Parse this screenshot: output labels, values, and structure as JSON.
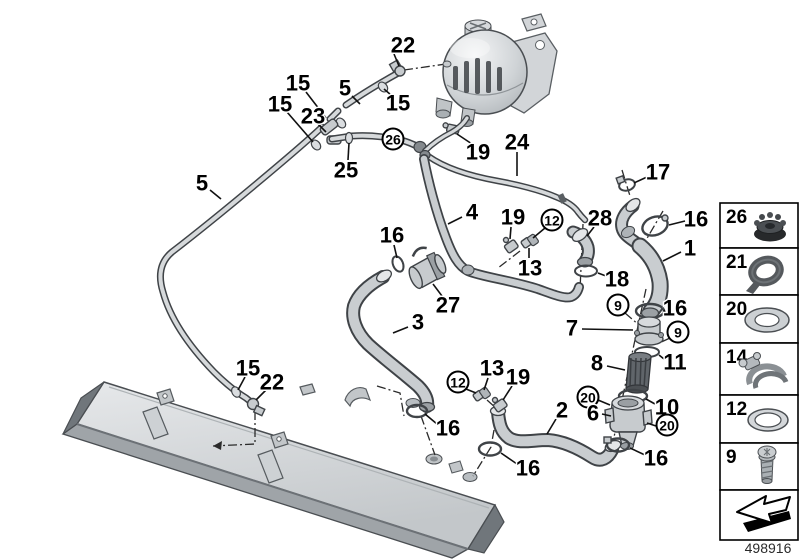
{
  "part_number": "498916",
  "sidebar": {
    "items": [
      {
        "number": "26",
        "icon": "rubber-mount-icon"
      },
      {
        "number": "21",
        "icon": "strap-loop-icon"
      },
      {
        "number": "20",
        "icon": "washer-icon"
      },
      {
        "number": "14",
        "icon": "hose-clamp-icon"
      },
      {
        "number": "12",
        "icon": "seal-ring-icon"
      },
      {
        "number": "9",
        "icon": "screw-icon"
      }
    ],
    "arrow_icon": "direction-arrow-icon"
  },
  "callouts": [
    {
      "text": "22",
      "x": 403,
      "y": 45,
      "circled": false,
      "leader": "394,54 399,66"
    },
    {
      "text": "15",
      "x": 398,
      "y": 103,
      "circled": false,
      "leader": "391,95 384,89"
    },
    {
      "text": "5",
      "x": 345,
      "y": 88,
      "circled": false,
      "leader": "352,96 360,104"
    },
    {
      "text": "15",
      "x": 298,
      "y": 83,
      "circled": false,
      "leader": "306,92 326,118"
    },
    {
      "text": "23",
      "x": 313,
      "y": 116,
      "circled": false,
      "leader": "318,124 326,132"
    },
    {
      "text": "15",
      "x": 280,
      "y": 104,
      "circled": false,
      "leader": "287,112 313,142"
    },
    {
      "text": "25",
      "x": 346,
      "y": 170,
      "circled": false,
      "leader": "348,160 349,143"
    },
    {
      "text": "26",
      "x": 393,
      "y": 139,
      "circled": true
    },
    {
      "text": "5",
      "x": 202,
      "y": 183,
      "circled": false,
      "leader": "210,190 221,199"
    },
    {
      "text": "19",
      "x": 478,
      "y": 152,
      "circled": false,
      "leader": "472,144 457,134"
    },
    {
      "text": "24",
      "x": 517,
      "y": 142,
      "circled": false,
      "leader": "517,152 517,176"
    },
    {
      "text": "17",
      "x": 658,
      "y": 172,
      "circled": false,
      "leader": "647,177 634,183"
    },
    {
      "text": "16",
      "x": 696,
      "y": 219,
      "circled": false,
      "leader": "685,221 669,225"
    },
    {
      "text": "1",
      "x": 690,
      "y": 248,
      "circled": false,
      "leader": "681,252 663,261"
    },
    {
      "text": "28",
      "x": 600,
      "y": 218,
      "circled": false,
      "leader": "594,227 587,236"
    },
    {
      "text": "19",
      "x": 513,
      "y": 217,
      "circled": false,
      "leader": "511,227 510,239"
    },
    {
      "text": "12",
      "x": 552,
      "y": 220,
      "circled": true,
      "leader": "545,228 533,238"
    },
    {
      "text": "13",
      "x": 530,
      "y": 268,
      "circled": false,
      "leader": "529,258 529,248"
    },
    {
      "text": "4",
      "x": 472,
      "y": 212,
      "circled": false,
      "leader": "462,217 448,224"
    },
    {
      "text": "18",
      "x": 617,
      "y": 279,
      "circled": false,
      "leader": "606,276 598,273"
    },
    {
      "text": "16",
      "x": 392,
      "y": 235,
      "circled": false,
      "leader": "394,245 397,258"
    },
    {
      "text": "27",
      "x": 448,
      "y": 305,
      "circled": false,
      "leader": "442,296 433,284"
    },
    {
      "text": "3",
      "x": 418,
      "y": 322,
      "circled": false,
      "leader": "408,327 393,333"
    },
    {
      "text": "16",
      "x": 675,
      "y": 308,
      "circled": false,
      "leader": "664,310 665,312"
    },
    {
      "text": "9",
      "x": 618,
      "y": 305,
      "circled": true
    },
    {
      "text": "7",
      "x": 572,
      "y": 328,
      "circled": false,
      "leader": "582,329 633,330"
    },
    {
      "text": "9",
      "x": 678,
      "y": 332,
      "circled": true
    },
    {
      "text": "11",
      "x": 675,
      "y": 362,
      "circled": false,
      "leader": "664,359 659,355"
    },
    {
      "text": "8",
      "x": 597,
      "y": 363,
      "circled": false,
      "leader": "607,366 625,370"
    },
    {
      "text": "10",
      "x": 667,
      "y": 407,
      "circled": false,
      "leader": "655,404 646,399"
    },
    {
      "text": "20",
      "x": 588,
      "y": 397,
      "circled": true,
      "leader": "598,400 610,405"
    },
    {
      "text": "6",
      "x": 593,
      "y": 413,
      "circled": false,
      "leader": "602,414 611,416"
    },
    {
      "text": "20",
      "x": 667,
      "y": 425,
      "circled": true,
      "leader": "656,426 647,423"
    },
    {
      "text": "16",
      "x": 656,
      "y": 458,
      "circled": false,
      "leader": "645,455 630,448"
    },
    {
      "text": "2",
      "x": 562,
      "y": 410,
      "circled": false,
      "leader": "556,419 547,434"
    },
    {
      "text": "16",
      "x": 528,
      "y": 468,
      "circled": false,
      "leader": "517,464 501,453"
    },
    {
      "text": "13",
      "x": 492,
      "y": 368,
      "circled": false,
      "leader": "488,378 484,390"
    },
    {
      "text": "19",
      "x": 518,
      "y": 377,
      "circled": false,
      "leader": "512,386 503,400"
    },
    {
      "text": "12",
      "x": 458,
      "y": 382,
      "circled": true,
      "leader": "466,389 476,393"
    },
    {
      "text": "16",
      "x": 448,
      "y": 428,
      "circled": false,
      "leader": "437,424 425,414"
    },
    {
      "text": "15",
      "x": 248,
      "y": 368,
      "circled": false,
      "leader": "245,377 238,390"
    },
    {
      "text": "22",
      "x": 272,
      "y": 382,
      "circled": false,
      "leader": "266,390 256,400"
    }
  ]
}
